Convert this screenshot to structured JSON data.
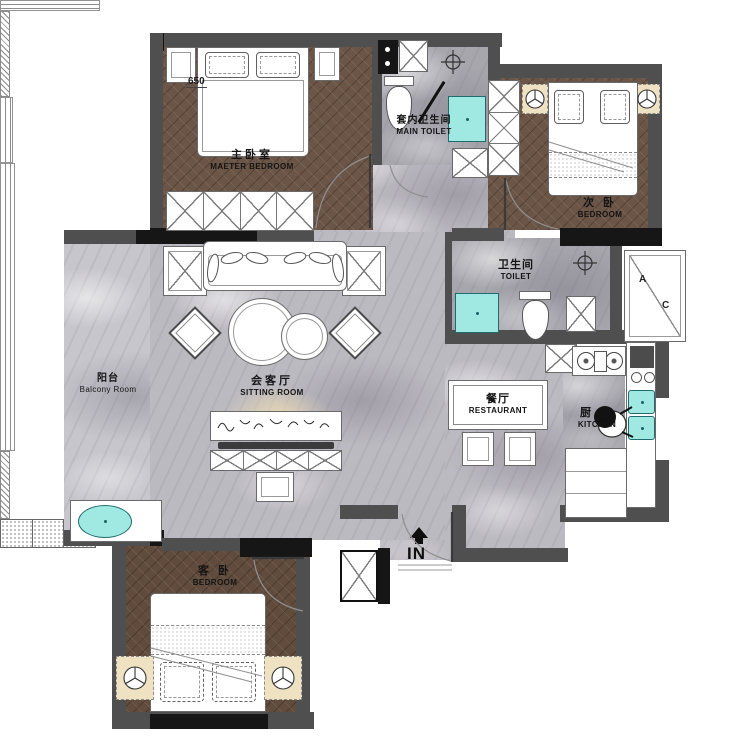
{
  "rooms": {
    "master_bedroom": {
      "zh": "主卧室",
      "en": "MAETER BEDROOM"
    },
    "main_toilet": {
      "zh": "套内卫生间",
      "en": "MAIN TOILET"
    },
    "second_bedroom": {
      "zh": "次 卧",
      "en": "BEDROOM"
    },
    "toilet": {
      "zh": "卫生间",
      "en": "TOILET"
    },
    "balcony": {
      "zh": "阳台",
      "en": "Balcony Room"
    },
    "sitting_room": {
      "zh": "会客厅",
      "en": "SITTING ROOM"
    },
    "dining_room": {
      "zh": "餐厅",
      "en": "RESTAURANT"
    },
    "kitchen": {
      "zh": "厨 房",
      "en": "KITCHEN"
    },
    "guest_bedroom": {
      "zh": "客 卧",
      "en": "BEDROOM"
    }
  },
  "annotations": {
    "entrance": "IN",
    "dimension": "650",
    "ac_a": "A",
    "ac_c": "C"
  },
  "colors": {
    "wall_gray": "#4f4f4f",
    "wall_black": "#161616",
    "wood_floor": "#6b5546",
    "marble_light": "#c7c6cc",
    "marble_mid": "#a7a6ad",
    "fixture_cyan": "#9fe9e2",
    "lamp_beige": "#eee2c3",
    "glow_beige": "#e9d8b2"
  }
}
